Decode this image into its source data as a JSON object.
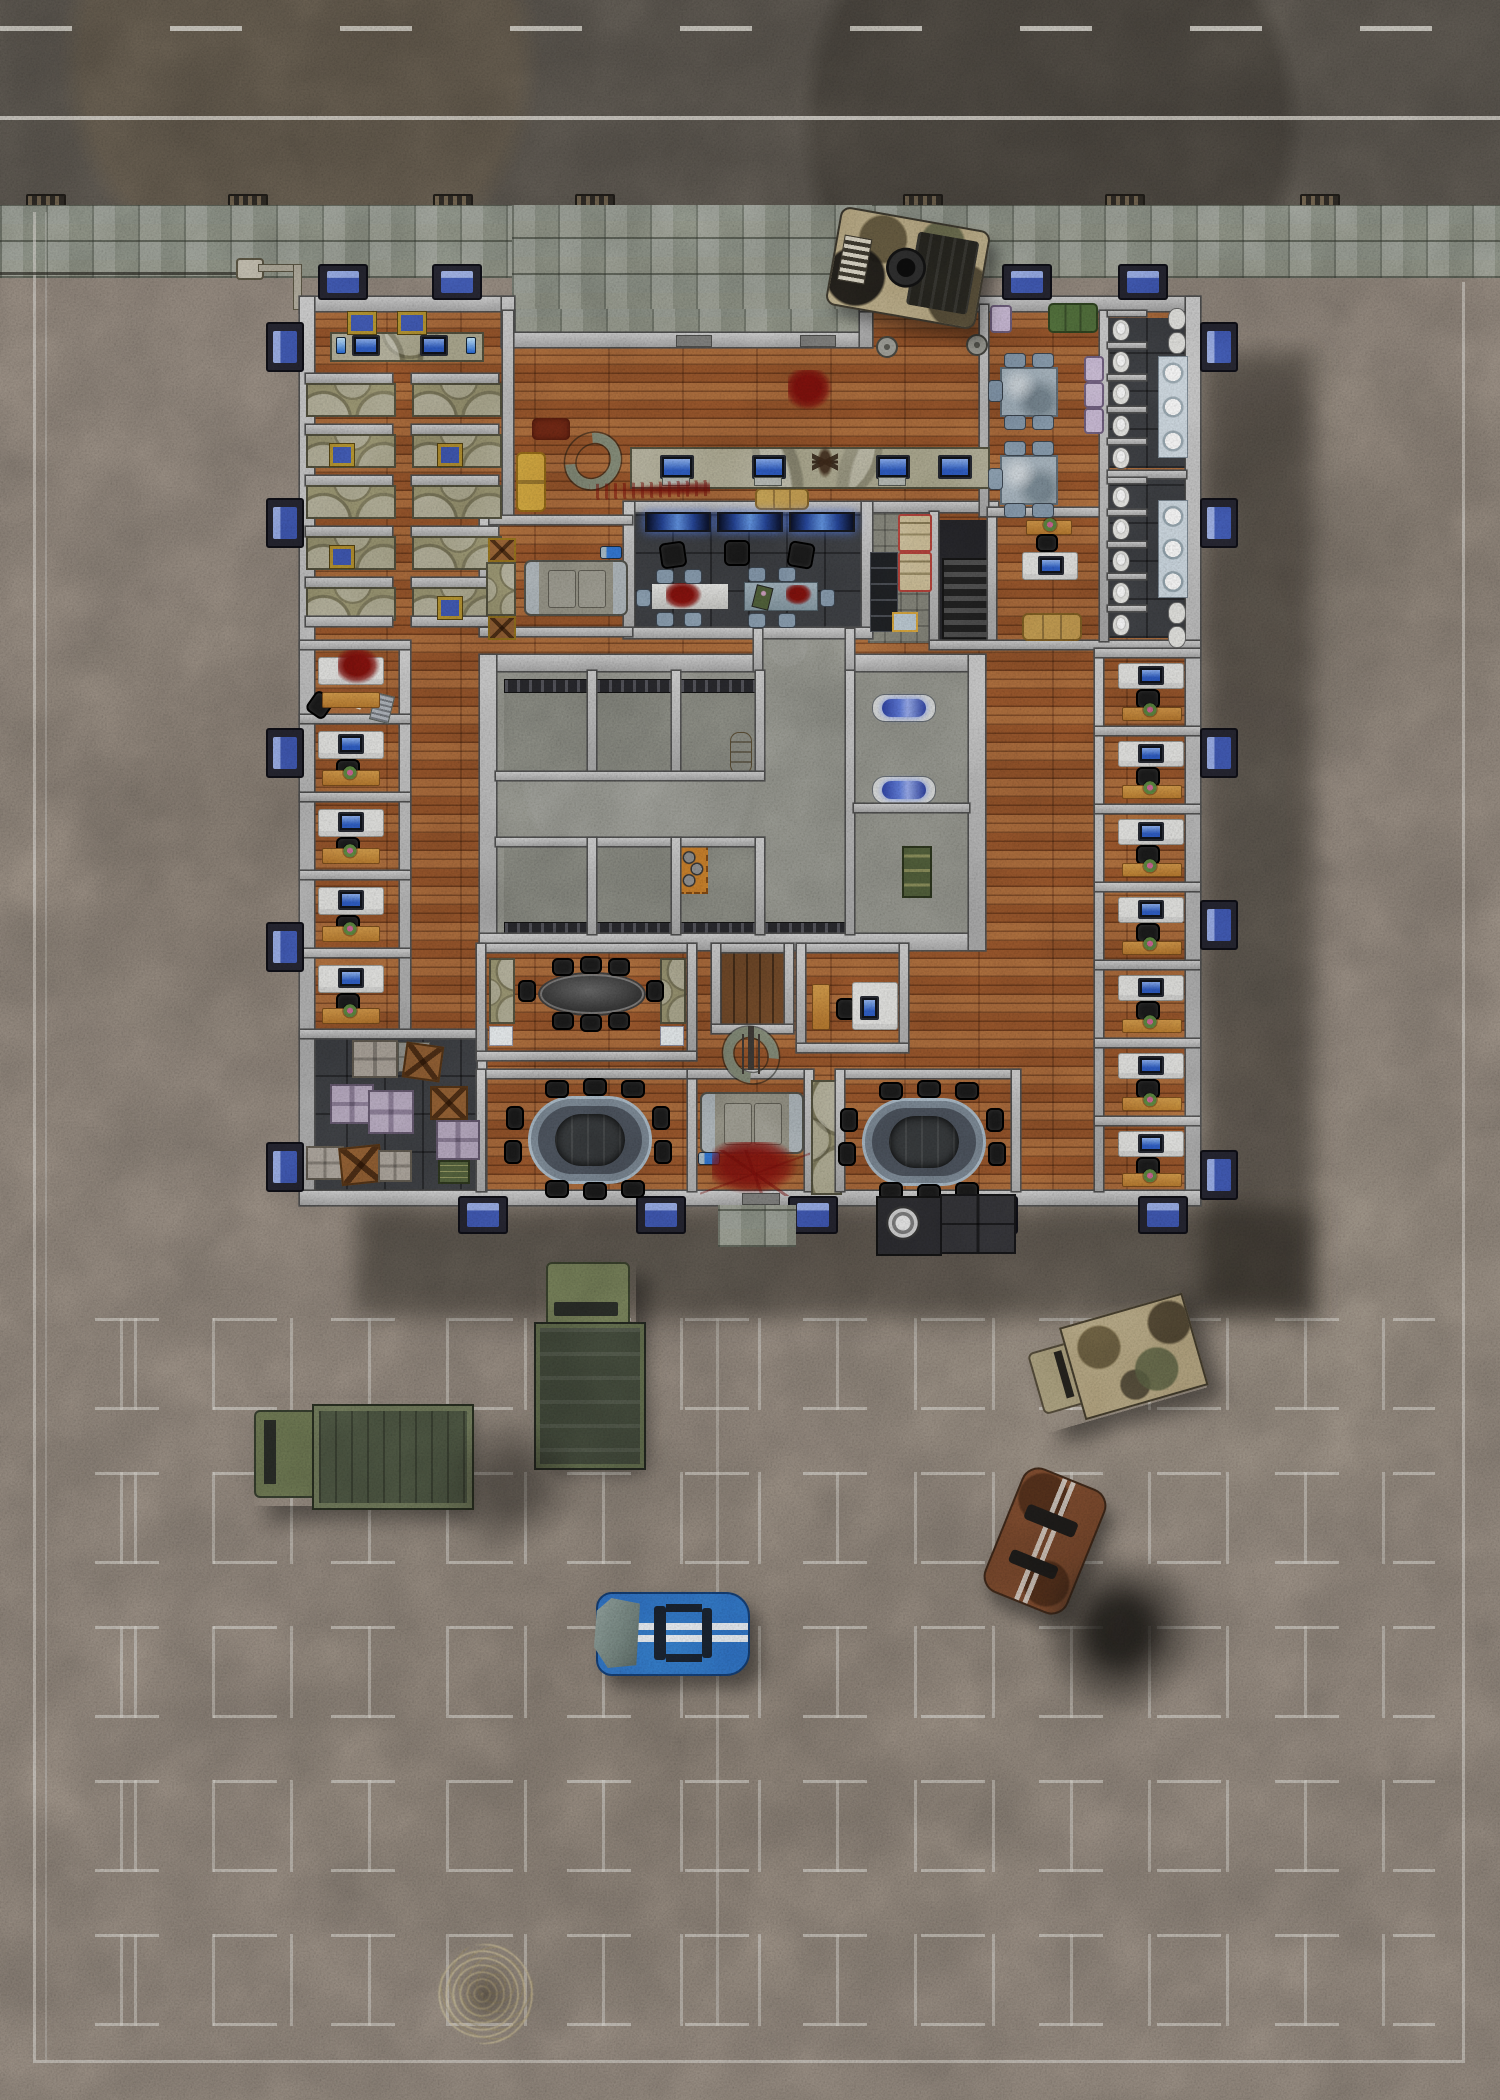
{
  "scene": {
    "title": "Top-down battle map: abandoned military office compound with parking lot",
    "view": "orthographic top-down",
    "visible_text": "none"
  },
  "palette": {
    "road_asphalt": "#57524b",
    "lane_marking": "#d8d5cc",
    "sidewalk_stone": "#8f958a",
    "lot_concrete": "#8b8177",
    "building_wall": "#bcbcbc",
    "wall_outline": "#4c4c4c",
    "wood_floor": "#9c5a2e",
    "dark_room_floor": "#3a3c40",
    "cell_block_floor": "#8f9088",
    "window_glass": "#4466bb",
    "window_frame": "#23232e",
    "cot_fabric": "#938e6c",
    "desk_white": "#e4e4e1",
    "credenza_orange": "#c8873d",
    "chair_black": "#191919",
    "stasis_pod_glass": "#5a74d8",
    "blood": "#7c100c",
    "building_shadow": "rgba(18,16,13,0.42)"
  },
  "exterior": {
    "road": {
      "dashed_lane_line": true,
      "solid_edge_line": true,
      "storm_drains": 7
    },
    "sidewalk": {
      "material": "stone pavers",
      "street_lamp": 1,
      "power_line": true
    },
    "parking_lot": {
      "stall_row_bands": 5,
      "center_divider_line": true,
      "perimeter_lines": [
        "left",
        "right",
        "bottom"
      ]
    },
    "vehicles": [
      {
        "name": "burnt-humvee",
        "desc": "destroyed camouflage humvee on entrance plaza"
      },
      {
        "name": "military-cargo-truck",
        "desc": "olive cab truck with dark covered bed"
      },
      {
        "name": "flatbed-army-truck",
        "desc": "olive flatbed truck parked horizontally"
      },
      {
        "name": "camo-box-truck",
        "desc": "camouflage box truck parked diagonally"
      },
      {
        "name": "rusted-car",
        "desc": "rusty sedan with pale racing stripes, parked diagonally"
      },
      {
        "name": "wrecked-blue-sports-car",
        "desc": "blue sports car with white racing stripes and crushed front end"
      }
    ],
    "props": [
      {
        "name": "scorch-smoke-patch",
        "count": 2
      },
      {
        "name": "dead-bush",
        "count": 1
      },
      {
        "name": "generator-and-crates",
        "desc": "at rear exit"
      },
      {
        "name": "stone-path",
        "desc": "rear walkway"
      }
    ]
  },
  "building": {
    "entrances": {
      "front_double_doors": 2,
      "rear_door": 1
    },
    "window_count": 19,
    "rooms": [
      {
        "name": "reception-office",
        "furniture": [
          "workstation counter",
          "2 monitors",
          "blue bottles",
          "gold wall screens"
        ]
      },
      {
        "name": "barracks",
        "furniture": [
          "10 cot cubicles in 2 columns",
          "small wall monitors"
        ]
      },
      {
        "name": "open-plan-office",
        "furniture": [
          "long workstation counter with 4 monitors",
          "yellow couch",
          "tan bench",
          "dark red rug",
          "snake remains",
          "dead creature",
          "blood splatter",
          "blood streak",
          "2 floor valves"
        ]
      },
      {
        "name": "briefing-room",
        "furniture": [
          "3 glowing wall displays",
          "3 black chairs",
          "white table with blood pool",
          "steel table with field radio and remains",
          "10 small chairs"
        ]
      },
      {
        "name": "garage-bay",
        "furniture": [
          "armored vehicle",
          "flashlight",
          "cot",
          "2 supply crates"
        ]
      },
      {
        "name": "equipment-corridor",
        "furniture": [
          "5 lockers",
          "2 red-trimmed cabinets",
          "supply box"
        ]
      },
      {
        "name": "stairwell",
        "furniture": [
          "staircase"
        ]
      },
      {
        "name": "break-room",
        "furniture": [
          "2 stone tables",
          "10 chairs",
          "green couch",
          "4 lavender chairs"
        ]
      },
      {
        "name": "executive-office",
        "furniture": [
          "desk with monitor",
          "chair",
          "credenza with plant",
          "tan couch"
        ]
      },
      {
        "name": "restroom-north",
        "furniture": [
          "5 stalls with toilets",
          "sink counter with 3 basins",
          "2 urinals"
        ]
      },
      {
        "name": "restroom-south",
        "furniture": [
          "5 stalls with toilets",
          "sink counter with 3 basins",
          "2 urinals"
        ]
      },
      {
        "name": "detention-block",
        "furniture": [
          "6 cells with vent grates",
          "supply barrel",
          "orange tool mat",
          "2 blue stasis pods",
          "army crate"
        ]
      },
      {
        "name": "conference-room",
        "furniture": [
          "dark oval table",
          "8 chairs",
          "2 privacy screens",
          "2 white consoles"
        ]
      },
      {
        "name": "freight-elevator",
        "furniture": [
          "wood platform"
        ]
      },
      {
        "name": "middle-office",
        "furniture": [
          "desk with monitor",
          "chair",
          "credenza",
          "snake remains",
          "coat rack"
        ]
      },
      {
        "name": "boardroom-west",
        "furniture": [
          "glass oval table",
          "10 chairs"
        ]
      },
      {
        "name": "machine-room",
        "furniture": [
          "armored machine",
          "large blood splatter",
          "flashlight"
        ]
      },
      {
        "name": "boardroom-east",
        "furniture": [
          "glass oval table",
          "10 chairs"
        ]
      },
      {
        "name": "storage-room",
        "furniture": [
          "metal crates",
          "wooden crates",
          "lavender crates",
          "pallet",
          "army chest"
        ]
      },
      {
        "name": "office-west",
        "count": 5,
        "note": "northernmost office ransacked: blood pool, overturned chair, scattered papers"
      },
      {
        "name": "office-east",
        "count": 7
      }
    ]
  }
}
